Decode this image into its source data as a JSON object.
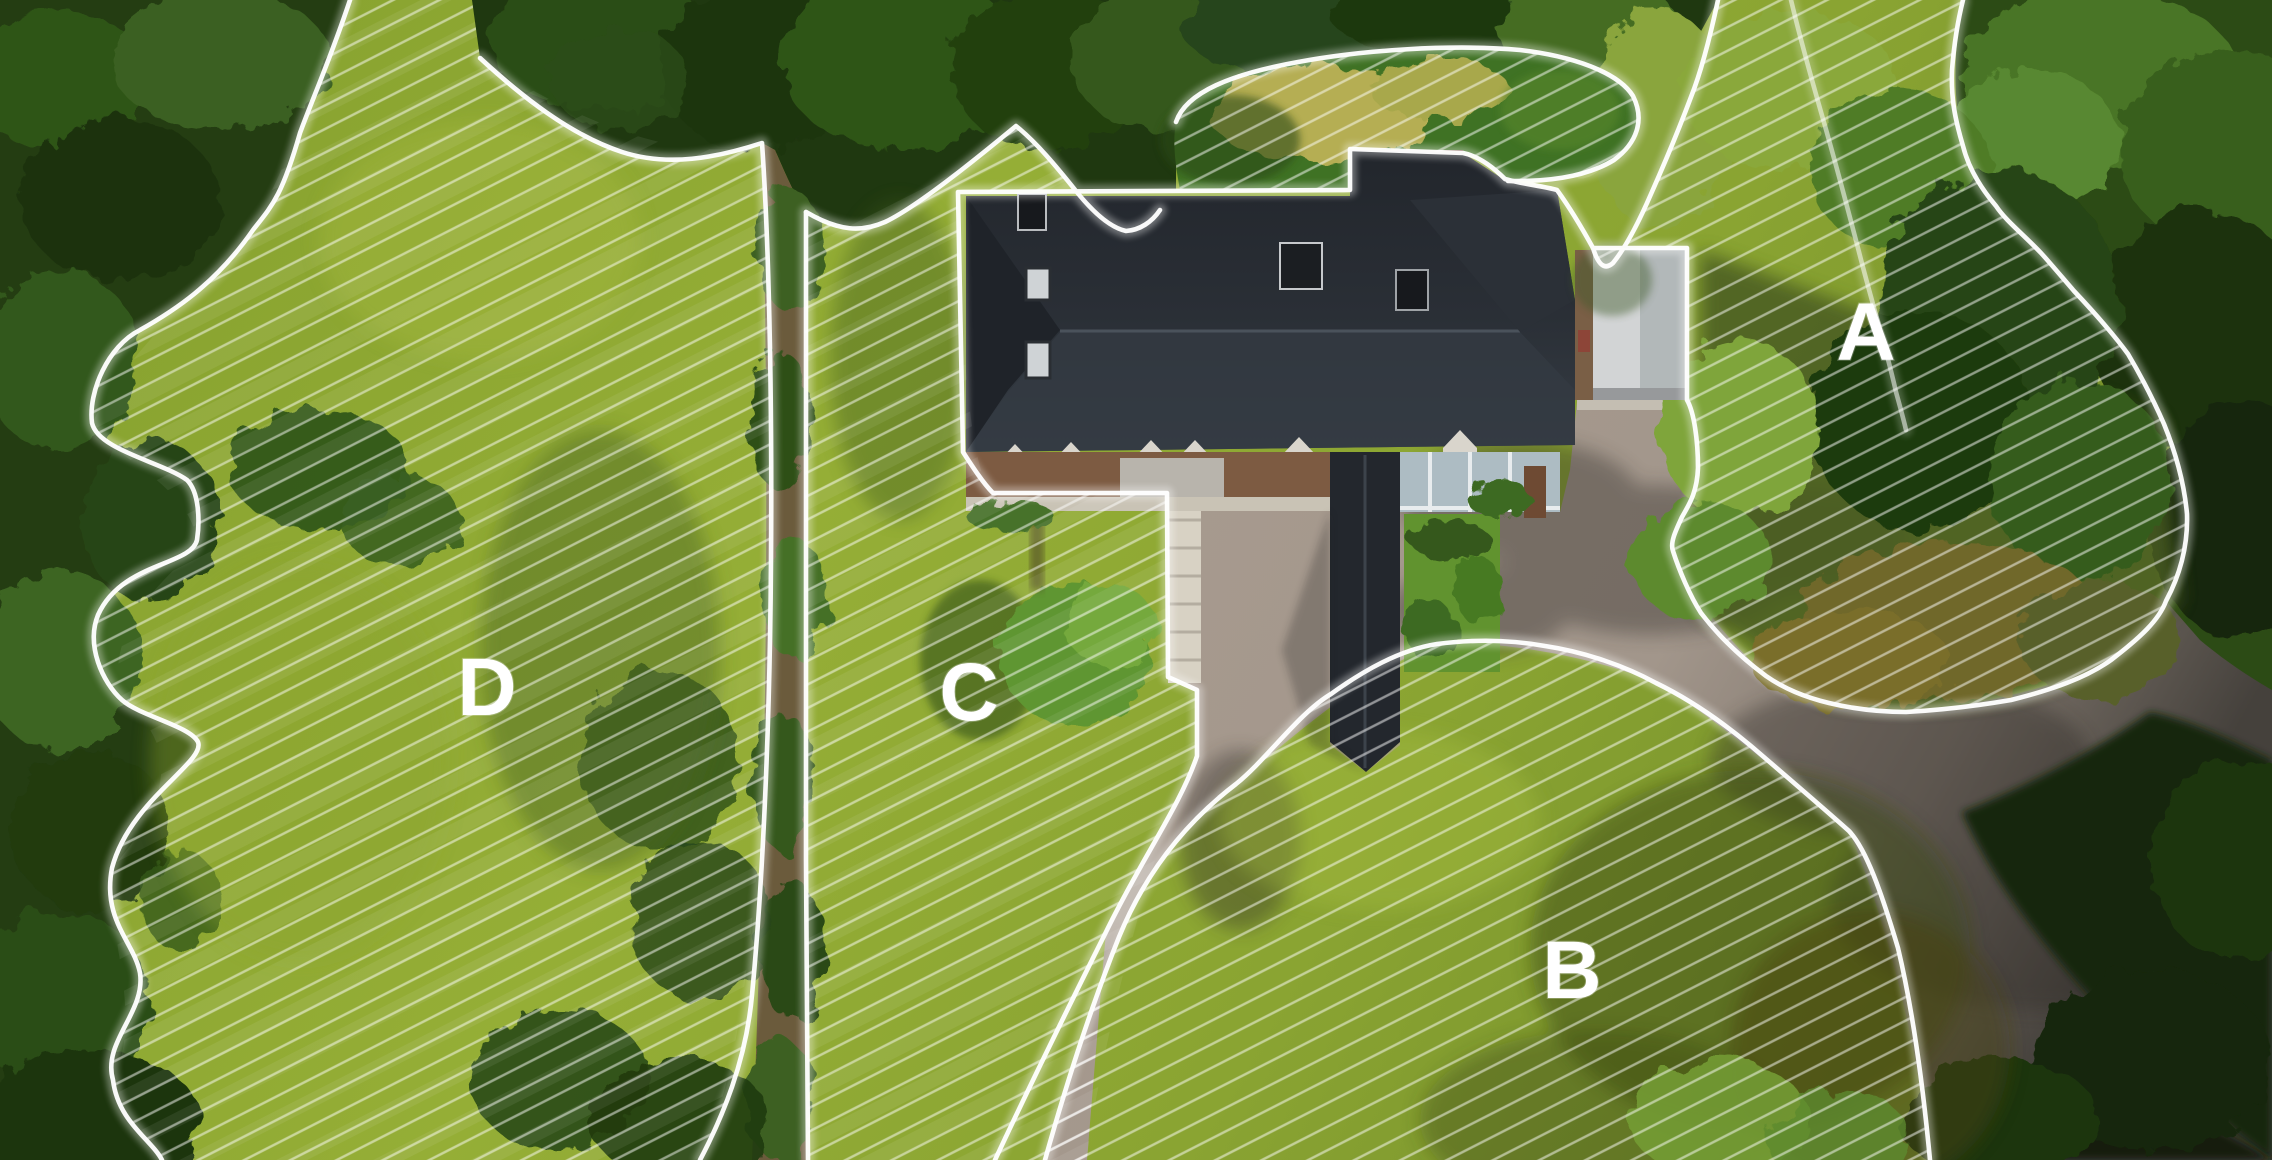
{
  "map": {
    "description": "Aerial drone photo of a property with a dark-roofed house, driveway, lawns and surrounding forest, overlaid with four white-outlined, diagonally hatched mowing zones",
    "zones": [
      {
        "id": "A",
        "label": "A"
      },
      {
        "id": "B",
        "label": "B"
      },
      {
        "id": "C",
        "label": "C"
      },
      {
        "id": "D",
        "label": "D"
      }
    ],
    "colors": {
      "zone_outline": "#ffffff",
      "zone_hatch": "#ffffff",
      "lawn_bright": "#93ab33",
      "lawn_olive": "#7d982b",
      "forest_dark": "#1f3810",
      "driveway": "#a2968b",
      "house_roof": "#262b31",
      "garage_roof": "#d2d4d5",
      "dry_grass": "#b5ae52"
    }
  }
}
